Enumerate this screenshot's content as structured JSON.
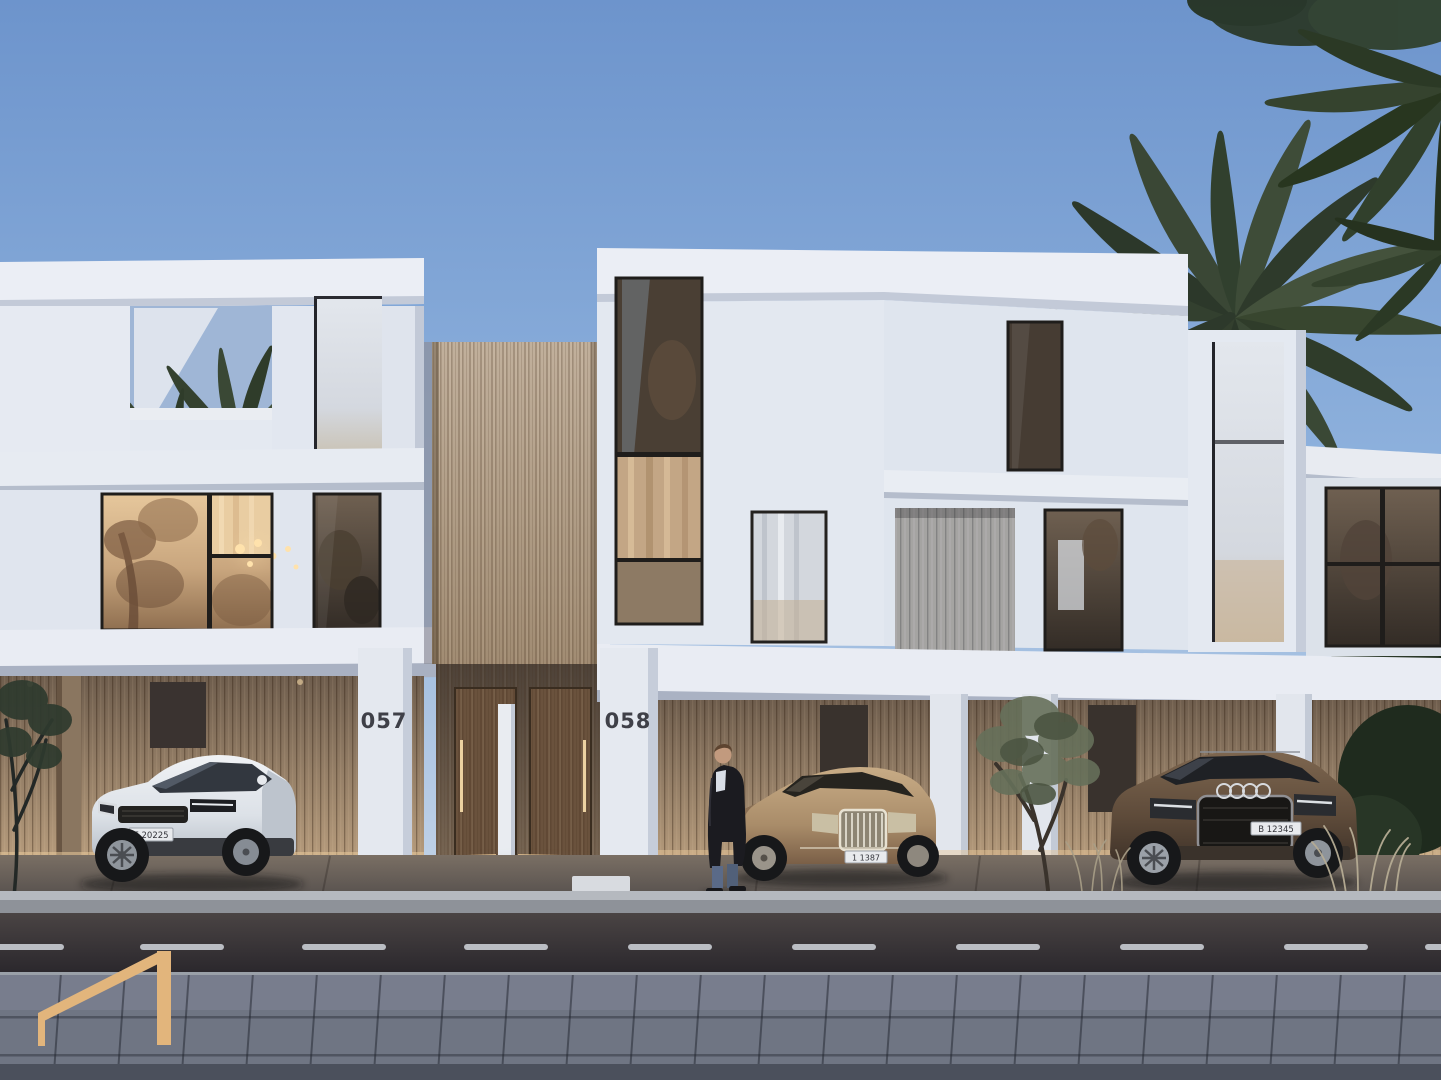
{
  "scene": {
    "description": "Dusk architectural rendering of two modern white villas with wood-clad carports, parked cars, palm trees, a man standing by the entrance, road with dashed lane marking and a gold logo mark",
    "houses": [
      {
        "number": "057"
      },
      {
        "number": "058"
      }
    ],
    "vehicles": [
      {
        "type": "white compact SUV",
        "plate": "E 20225"
      },
      {
        "type": "bronze luxury sedan",
        "plate": "1 1387"
      },
      {
        "type": "brown SUV",
        "plate": "B 12345"
      }
    ],
    "logo": {
      "color": "#E2B57C"
    },
    "palette": {
      "sky_top": "#6D94CC",
      "sky_horizon": "#D8DDE8",
      "wall_white": "#E9EDF4",
      "wood": "#AE9880",
      "asphalt": "#322E33",
      "paver": "#6F7583",
      "window_warm": "#C9A67E",
      "glow": "#F0D2A0",
      "number_color": "#3F4048"
    }
  }
}
